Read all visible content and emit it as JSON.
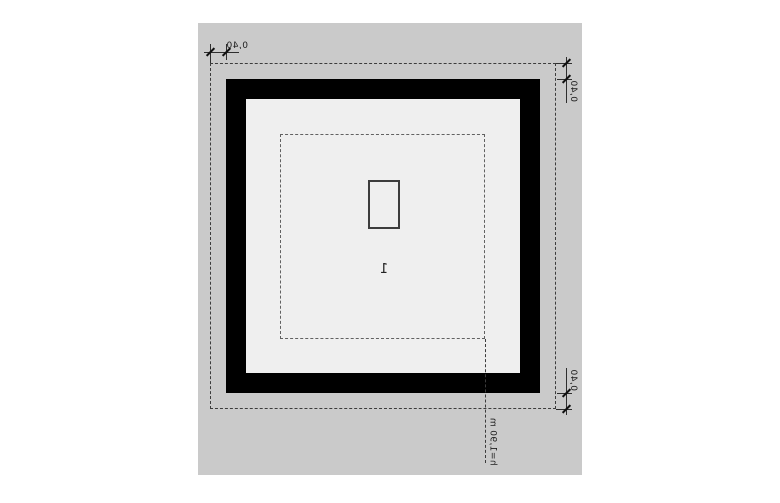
{
  "drawing": {
    "room_number": "1",
    "height_annotation": "h=1,90 m",
    "dimensions": {
      "top_left": "0,40",
      "top_right": "0,40",
      "bottom_right": "0,40"
    }
  },
  "colors": {
    "page_background": "#ffffff",
    "site_gray": "#cacaca",
    "floor_light": "#efefef",
    "wall_black": "#000000",
    "dashed_line": "#3c3c3c",
    "text": "#1d1d1d"
  }
}
